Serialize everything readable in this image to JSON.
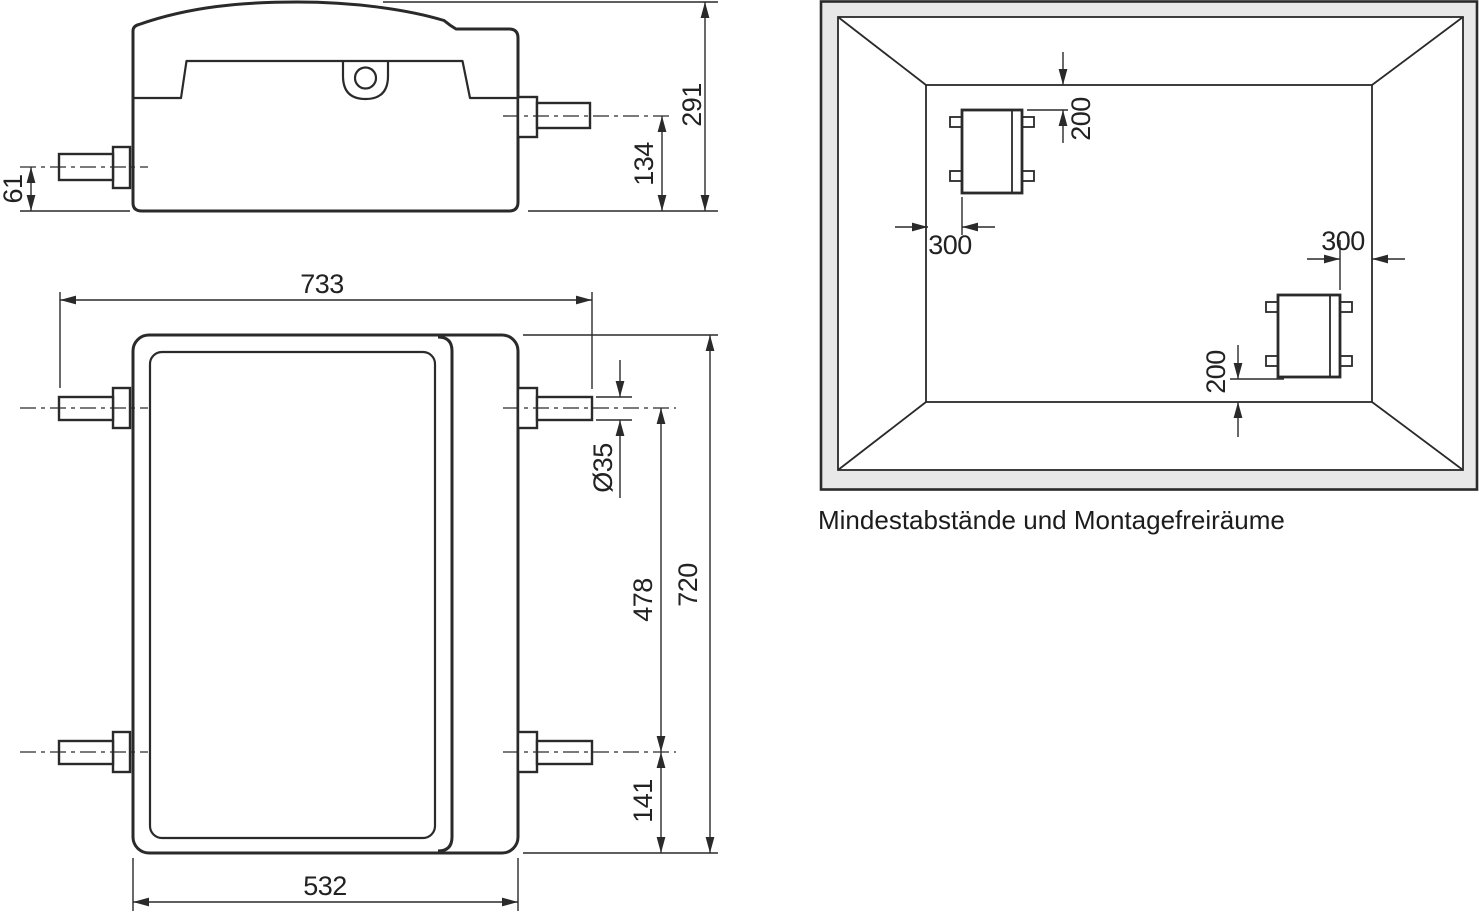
{
  "colors": {
    "line": "#2a2a2a",
    "wall_band_fill": "#e8e8e8",
    "background": "#ffffff"
  },
  "side_view": {
    "dims": {
      "pipe_axis_to_bottom": "61",
      "right_pipe_axis_to_bottom": "134",
      "overall_height": "291"
    }
  },
  "top_view": {
    "dims": {
      "overall_width_pipes": "733",
      "pipe_diameter": "Ø35",
      "pipe_axis_spacing": "478",
      "overall_depth": "720",
      "lower_pipe_axis_to_edge": "141",
      "body_width": "532"
    }
  },
  "clearance_diagram": {
    "caption": "Mindestabstände und Montagefreiräume",
    "dims": {
      "upper_top_clearance": "200",
      "upper_side_clearance": "300",
      "lower_side_clearance": "300",
      "lower_bottom_clearance": "200"
    }
  }
}
